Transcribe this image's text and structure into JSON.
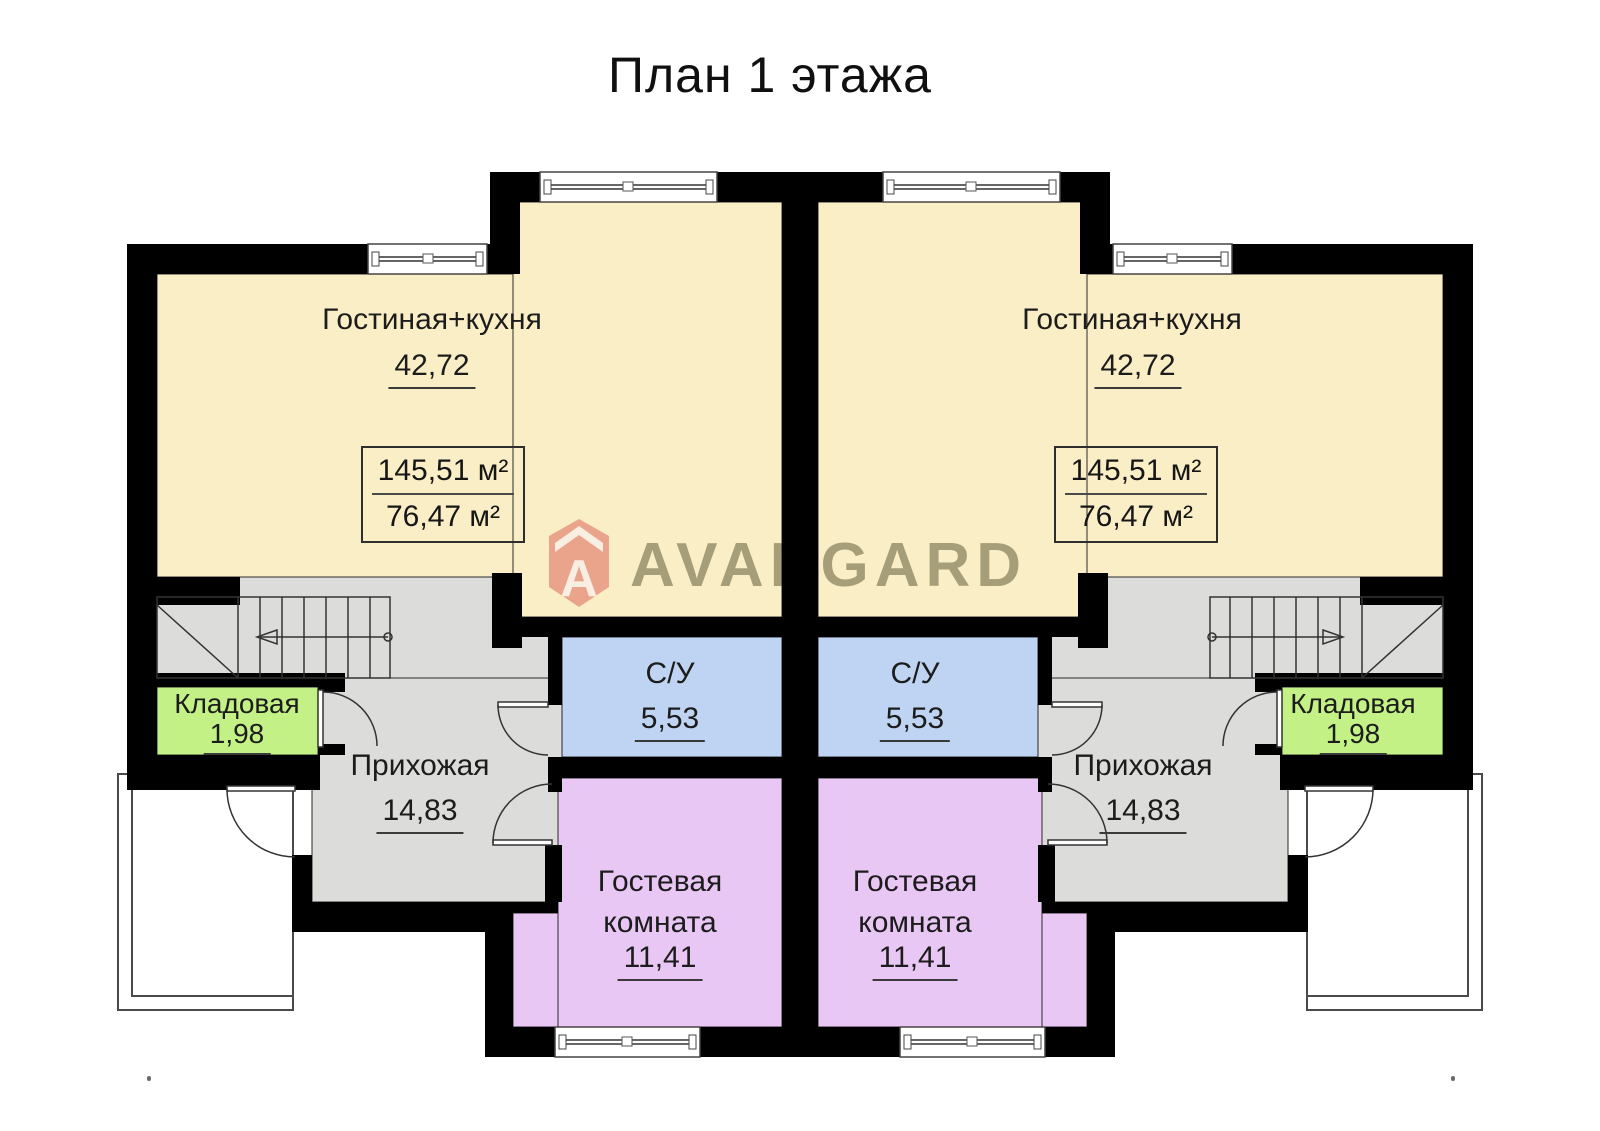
{
  "title": "План 1 этажа",
  "watermark": {
    "brand": "AVANGARD",
    "logo_letter": "A",
    "accent_color": "#e89a84",
    "text_color": "#a9a99b"
  },
  "rooms": {
    "living": {
      "name": "Гостиная+кухня",
      "area": "42,72",
      "color": "#faeec6"
    },
    "bathroom": {
      "name": "С/У",
      "area": "5,53",
      "color": "#bfd4f2"
    },
    "hallway": {
      "name": "Прихожая",
      "area": "14,83",
      "color": "#dcdcda"
    },
    "storage": {
      "name": "Кладовая",
      "area": "1,98",
      "color": "#c3f185"
    },
    "guest": {
      "name": "Гостевая комната",
      "area": "11,41",
      "color": "#e9c7f4"
    }
  },
  "area_box": {
    "total_area": "145,51 м²",
    "living_area": "76,47 м²"
  },
  "colors": {
    "walls": "#000000",
    "background": "#ffffff",
    "lines": "#333333"
  }
}
